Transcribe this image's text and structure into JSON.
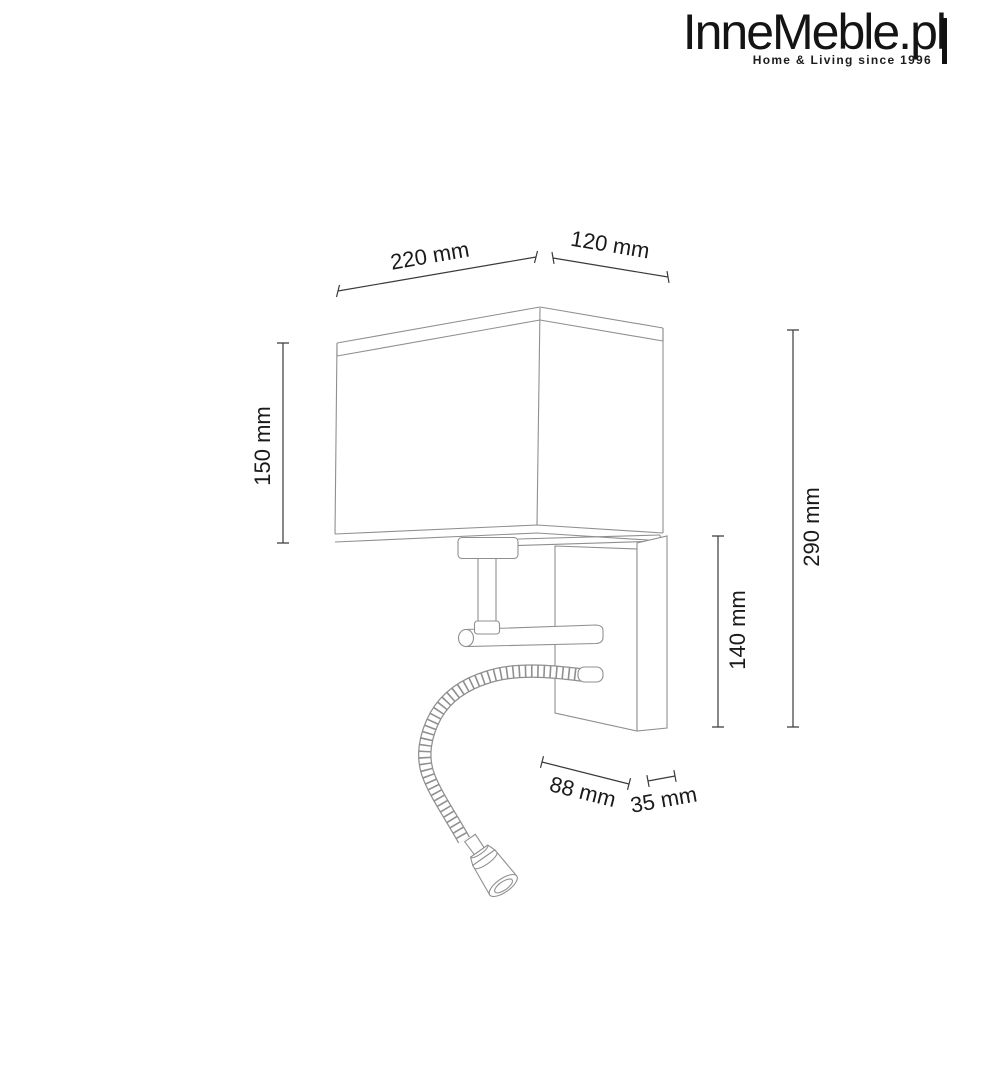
{
  "logo": {
    "brand": "InneMeble.pl",
    "tagline": "Home & Living since 1996"
  },
  "drawing": {
    "dimensions": {
      "shade_width": "220 mm",
      "shade_depth": "120 mm",
      "shade_height": "150 mm",
      "total_height": "290 mm",
      "bracket_height": "140 mm",
      "arm_length": "88 mm",
      "bracket_depth": "35 mm"
    },
    "colors": {
      "outline": "#8f8f8f",
      "dimension_line": "#3a3a3a",
      "label_text": "#1a1a1a",
      "background": "#ffffff"
    }
  }
}
